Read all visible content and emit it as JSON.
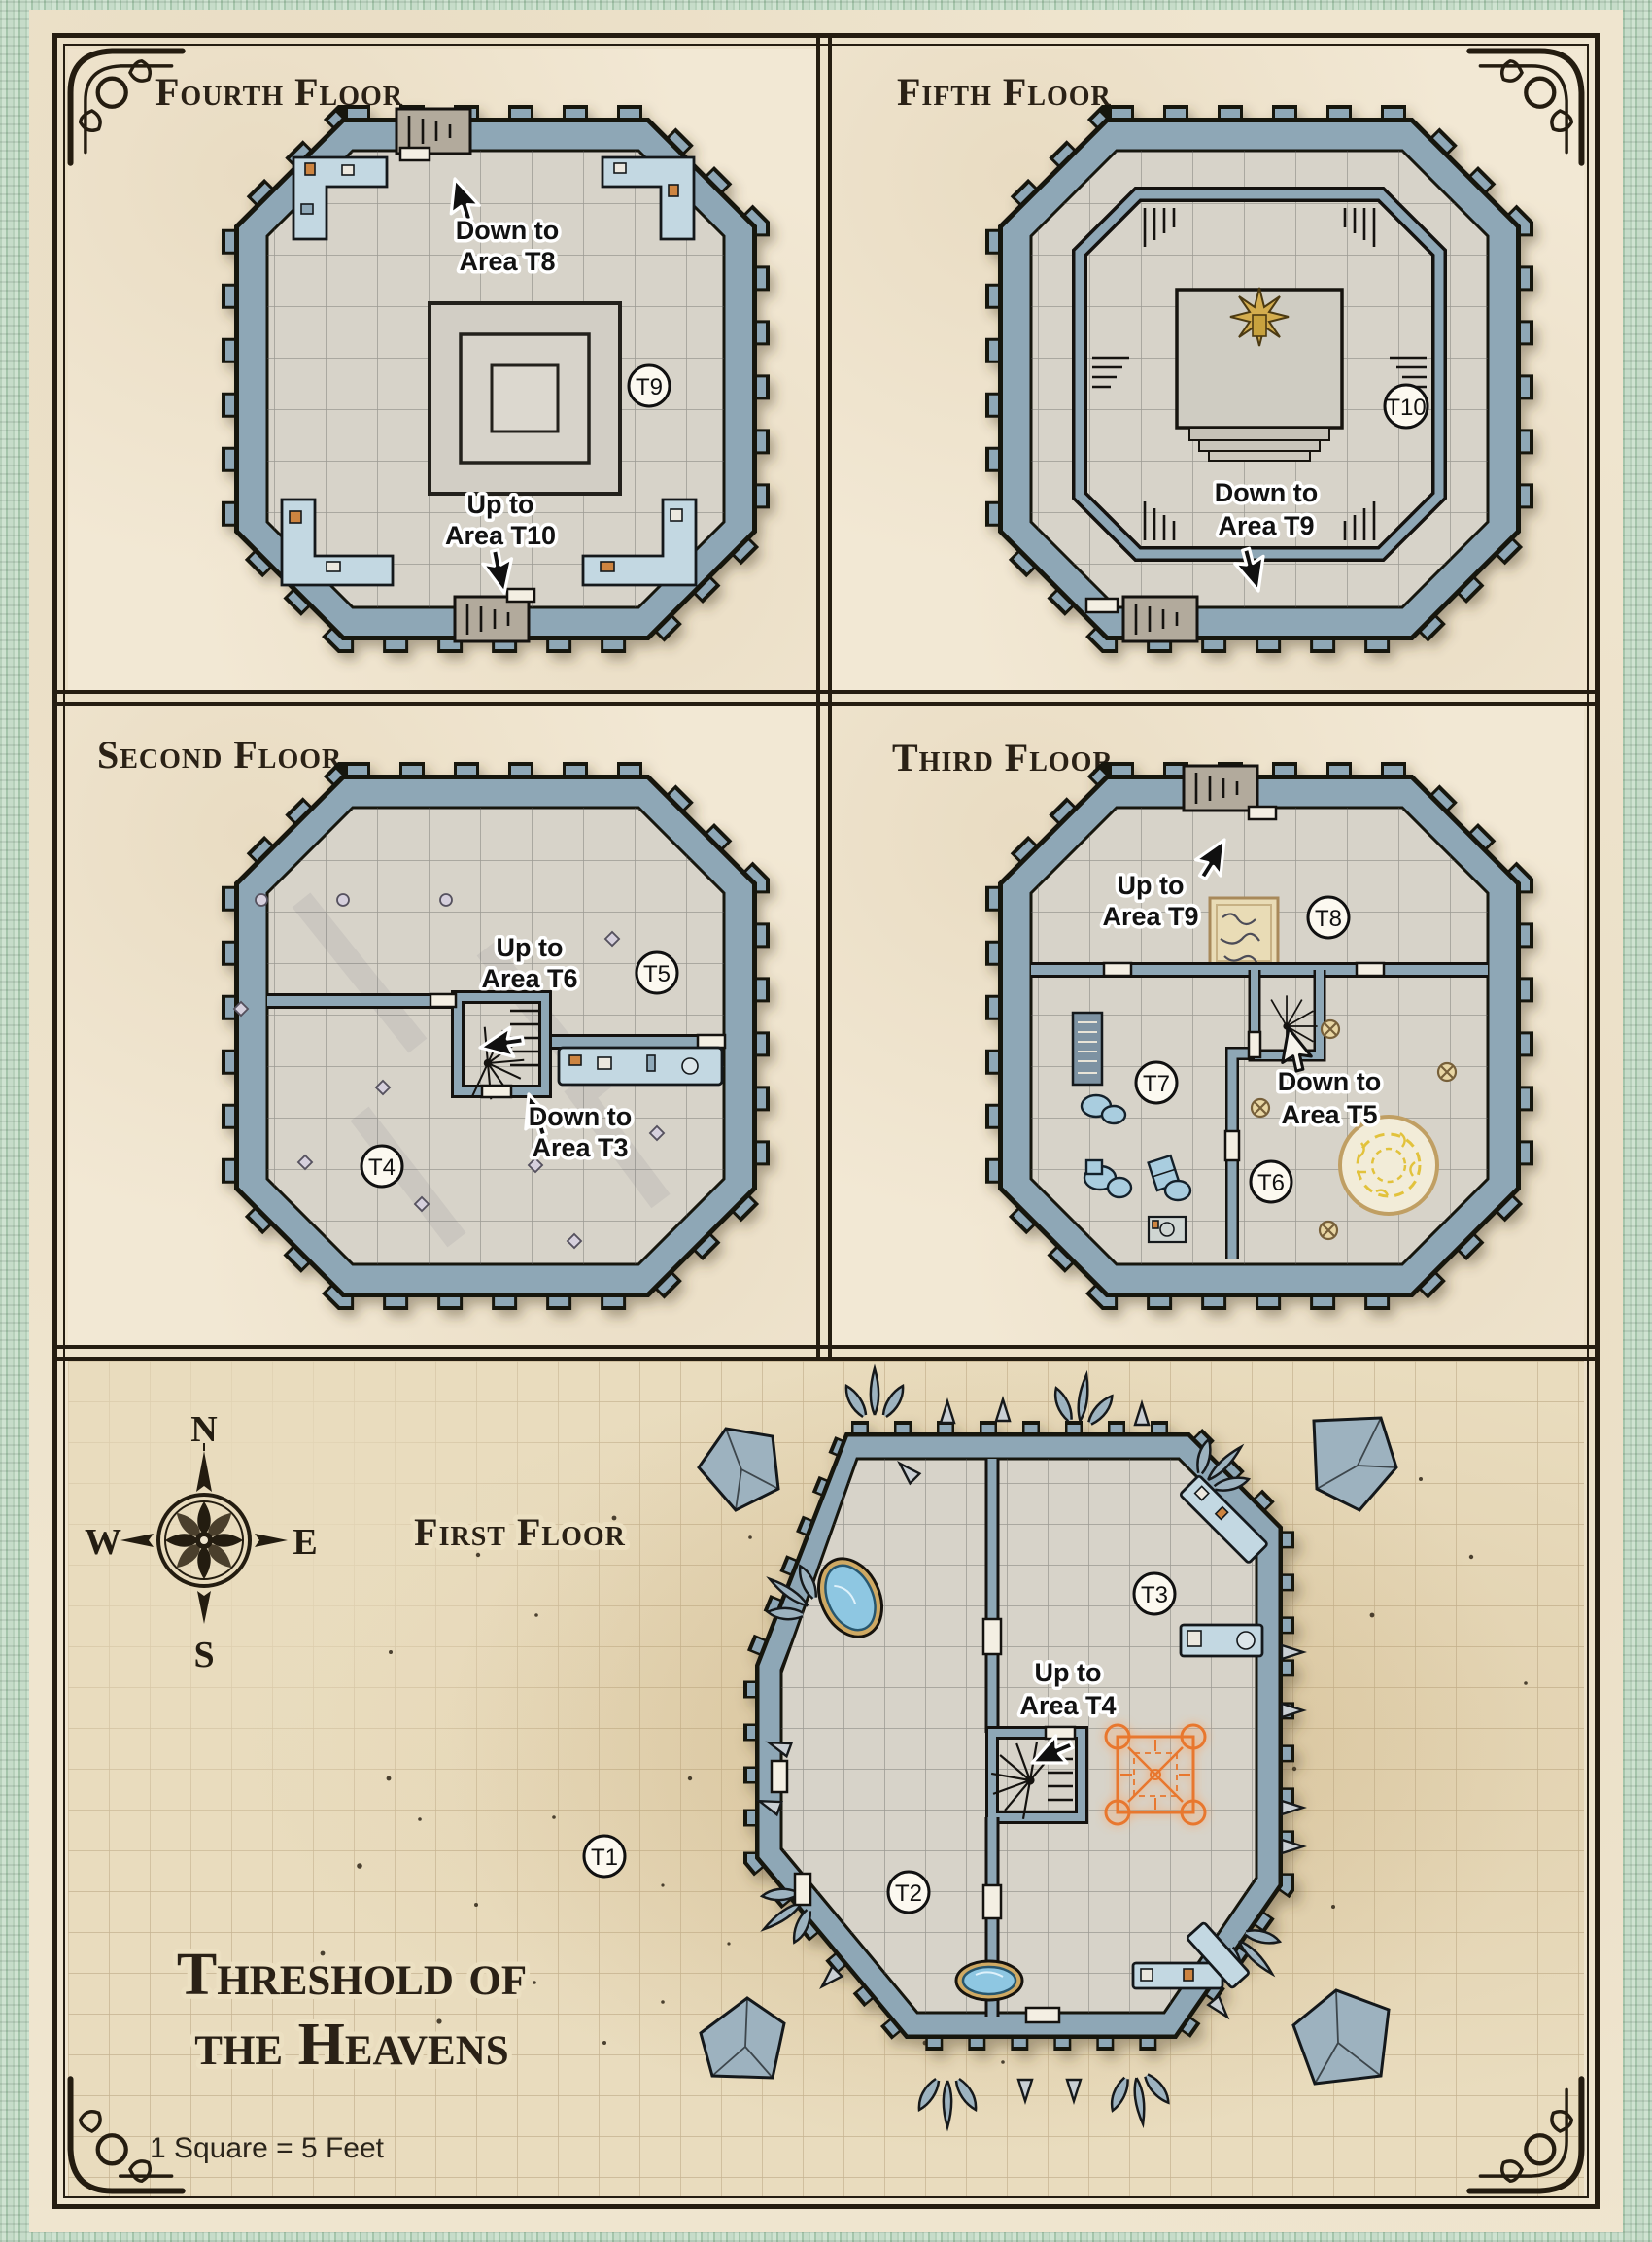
{
  "page": {
    "main_title_line1": "Threshold of",
    "main_title_line2": "the Heavens",
    "scale_note": "1 Square = 5 Feet",
    "compass": {
      "n": "N",
      "e": "E",
      "s": "S",
      "w": "W"
    }
  },
  "floors": {
    "fourth": {
      "title": "Fourth Floor",
      "marker_t9": "T9",
      "down": {
        "line1": "Down to",
        "line2": "Area T8"
      },
      "up": {
        "line1": "Up to",
        "line2": "Area T10"
      }
    },
    "fifth": {
      "title": "Fifth Floor",
      "marker_t10": "T10",
      "down": {
        "line1": "Down to",
        "line2": "Area T9"
      }
    },
    "second": {
      "title": "Second Floor",
      "marker_t5": "T5",
      "marker_t4": "T4",
      "up": {
        "line1": "Up to",
        "line2": "Area T6"
      },
      "down": {
        "line1": "Down to",
        "line2": "Area T3"
      }
    },
    "third": {
      "title": "Third Floor",
      "marker_t8": "T8",
      "marker_t7": "T7",
      "marker_t6": "T6",
      "up": {
        "line1": "Up to",
        "line2": "Area T9"
      },
      "down": {
        "line1": "Down to",
        "line2": "Area T5"
      }
    },
    "first": {
      "title": "First Floor",
      "marker_t1": "T1",
      "marker_t2": "T2",
      "marker_t3": "T3",
      "up": {
        "line1": "Up to",
        "line2": "Area T4"
      }
    }
  },
  "colors": {
    "wall_stone": "#8ea7b6",
    "parchment": "#f2e8d4",
    "sand": "#e9dcbe",
    "border_green": "#c6dcc9",
    "glyph_orange": "#e8772e",
    "glyph_yellow": "#e2c23c",
    "pool_blue": "#8ec7e2",
    "statue_gold": "#d4ad4e"
  }
}
